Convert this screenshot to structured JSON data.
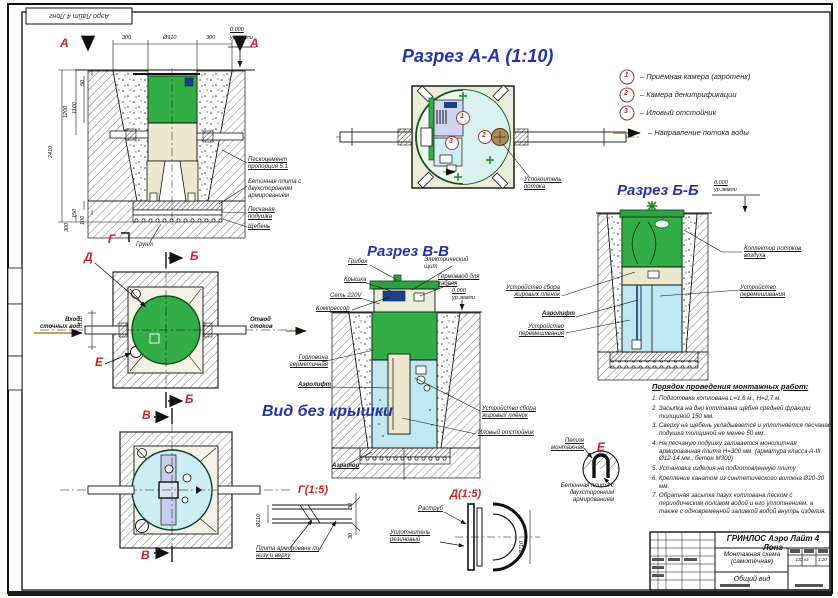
{
  "corner_stamp": "Аэро Лайт 4 Лонг",
  "markers": {
    "a": "А",
    "b": "Б",
    "v": "В",
    "g": "Г",
    "d": "Д",
    "e": "Е"
  },
  "common": {
    "level": "0.000",
    "level_sub": "ур.земли",
    "separator": "–"
  },
  "sections": {
    "aa_title": "Разрез А-А (1:10)",
    "vv_title": "Разрез В-В",
    "bb_title": "Разрез Б-Б",
    "nolid_title": "Вид без крышки",
    "g_title": "Г(1:5)",
    "d_title": "Д(1:5)"
  },
  "legend": {
    "items": [
      {
        "num": "1",
        "text": "Приёмная камера (аэротенк)"
      },
      {
        "num": "2",
        "text": "Камера денитрификации"
      },
      {
        "num": "3",
        "text": "Иловый отстойник"
      }
    ],
    "flow": "Направление потока воды"
  },
  "elevation": {
    "dim_300l": "300",
    "dim_d910": "Ø910",
    "dim_300r": "300",
    "dim_2410": "2410",
    "dim_1200": "1200",
    "dim_1100": "1100",
    "dim_50": "50",
    "dim_150": "150",
    "dim_100": "100",
    "dim_300b": "300",
    "lbl_sandcement": "Пескоцемент пропорция 5:1",
    "lbl_plate": "Бетонная плита с двухсторонним армированием",
    "lbl_sand": "Песчаная подушка",
    "lbl_gravel": "Щебень",
    "lbl_ground": "Грунт"
  },
  "plan": {
    "inlet": "Вход сточных вод",
    "outlet": "Отвод стоков",
    "dim_d110": "d110"
  },
  "aa": {
    "c1": "1",
    "c2": "2",
    "c3": "3",
    "lbl_calm": "Успокоитель потока"
  },
  "vv": {
    "lbl_mushroom": "Грибок",
    "lbl_lid": "Крышка",
    "lbl_net": "Сеть 220V",
    "lbl_compressor": "Компрессор",
    "lbl_panel": "Электрический щит",
    "lbl_gland": "Гермоввод для кабеля",
    "lbl_neck": "Горловина герметичная",
    "lbl_airlift": "Аэролифт",
    "lbl_grease": "Устройство сбора жировых плёнок",
    "lbl_sludge": "Иловый отстойник",
    "lbl_aerator": "Аэратор"
  },
  "bb": {
    "lbl_collector": "Коллектор потоков воздуха",
    "lbl_mixer": "Устройство перемешивания",
    "lbl_grease": "Устройство сбора жировых пленок",
    "lbl_airlift": "Аэролифт"
  },
  "details": {
    "g_label": "Плита армирована по низу и верху",
    "g_dim30a": "30",
    "g_dim30b": "30",
    "g_dia": "Ø110",
    "d_rastrub": "Раструб",
    "d_seal": "Уплотнитель резиновый",
    "d_dia": "Ø110",
    "e_loop": "Петля монтажная",
    "e_plate": "Бетонная плита с двухсторонним армированием"
  },
  "instructions": {
    "title": "Порядок проведения монтажных работ:",
    "items": [
      "1. Подготовка котлована L=1,6 м., Н=2,7 м.",
      "2. Засыпка на дно котлована щебня средней фракции толщиной 150 мм.",
      "3. Сверху на щебень укладывается и уплотняется песчаная подушка толщиной не менее 50 мм.",
      "4. На песчаную подушку заливается монолитная армированная плита Н=300 мм. (арматура класса А-III Ø12-14 мм., бетон М300)",
      "5. Установка изделия на подготовленную плиту",
      "6. Крепление канатом из синтетического волокна Ø20-30 мм.",
      "7. Обратная засыпка пазух котлована песком с периодическим поливом водой и его уплотнением, а также с одновременной заливкой водой внутрь изделия."
    ]
  },
  "titleblock": {
    "product": "ГРИНЛОС Аэро Лайт 4 Лонг",
    "doc": "Монтажная схема (самотёчная)",
    "view": "Общий вид",
    "mass": "132 кг",
    "scale": "1:20"
  },
  "colors": {
    "green": "#33ae47",
    "water": "#bfe8f2",
    "title_blue": "#2433a6",
    "marker_red": "#cc2222",
    "flow_orange": "#b87b2e"
  }
}
